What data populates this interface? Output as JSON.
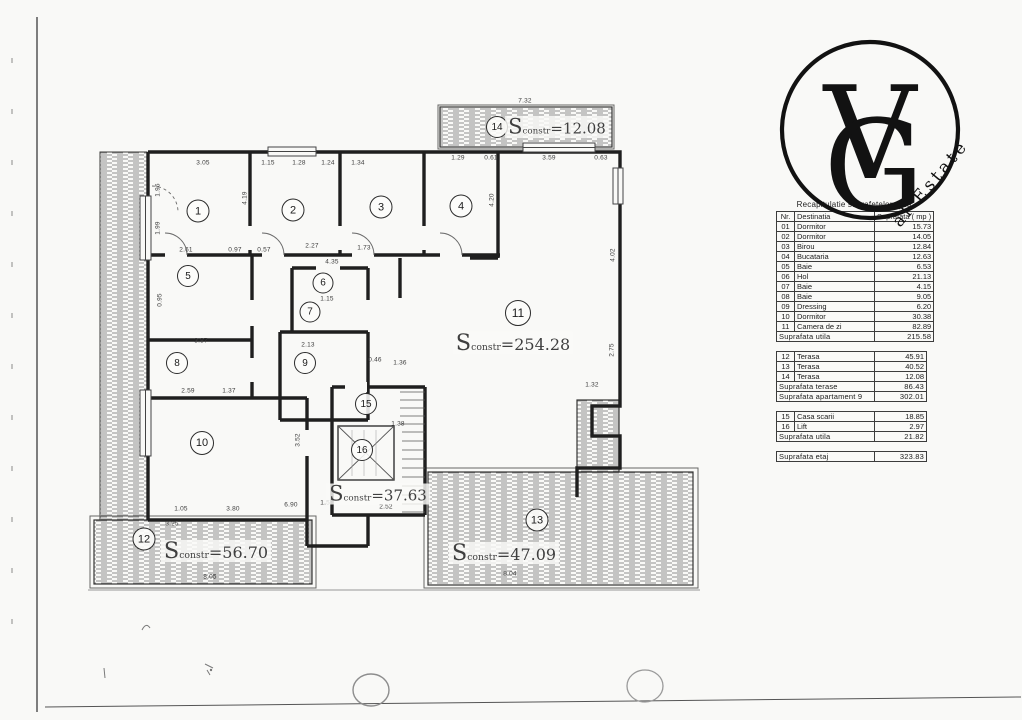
{
  "logo": {
    "monogram_v": "V",
    "monogram_g": "G",
    "tagline": "al Estate"
  },
  "summary": {
    "title": "Recapitulatie suprafetelor ap.9",
    "columns": [
      "Nr.",
      "Destinatia",
      "Suprafata ( mp )"
    ],
    "rooms": [
      {
        "nr": "01",
        "name": "Dormitor",
        "area": "15.73"
      },
      {
        "nr": "02",
        "name": "Dormitor",
        "area": "14.05"
      },
      {
        "nr": "03",
        "name": "Birou",
        "area": "12.84"
      },
      {
        "nr": "04",
        "name": "Bucataria",
        "area": "12.63"
      },
      {
        "nr": "05",
        "name": "Baie",
        "area": "6.53"
      },
      {
        "nr": "06",
        "name": "Hol",
        "area": "21.13"
      },
      {
        "nr": "07",
        "name": "Baie",
        "area": "4.15"
      },
      {
        "nr": "08",
        "name": "Baie",
        "area": "9.05"
      },
      {
        "nr": "09",
        "name": "Dressing",
        "area": "6.20"
      },
      {
        "nr": "10",
        "name": "Dormitor",
        "area": "30.38"
      },
      {
        "nr": "11",
        "name": "Camera de zi",
        "area": "82.89"
      }
    ],
    "total_utila": {
      "label": "Suprafata utila",
      "value": "215.58"
    },
    "terraces": [
      {
        "nr": "12",
        "name": "Terasa",
        "area": "45.91"
      },
      {
        "nr": "13",
        "name": "Terasa",
        "area": "40.52"
      },
      {
        "nr": "14",
        "name": "Terasa",
        "area": "12.08"
      }
    ],
    "terrace_total": {
      "label": "Suprafata terase",
      "value": "86.43"
    },
    "apartment_total": {
      "label": "Suprafata apartament 9",
      "value": "302.01"
    },
    "common": [
      {
        "nr": "15",
        "name": "Casa scarii",
        "area": "18.85"
      },
      {
        "nr": "16",
        "name": "Lift",
        "area": "2.97"
      }
    ],
    "common_total": {
      "label": "Suprafata utila",
      "value": "21.82"
    },
    "floor_total": {
      "label": "Suprafata etaj",
      "value": "323.83"
    }
  },
  "plan": {
    "room_numbers": [
      {
        "n": "1",
        "x": 198,
        "y": 211,
        "s": 21
      },
      {
        "n": "2",
        "x": 293,
        "y": 210,
        "s": 21
      },
      {
        "n": "3",
        "x": 381,
        "y": 207,
        "s": 21
      },
      {
        "n": "4",
        "x": 461,
        "y": 206,
        "s": 21
      },
      {
        "n": "5",
        "x": 188,
        "y": 276,
        "s": 20
      },
      {
        "n": "6",
        "x": 323,
        "y": 283,
        "s": 19
      },
      {
        "n": "7",
        "x": 310,
        "y": 312,
        "s": 19
      },
      {
        "n": "8",
        "x": 177,
        "y": 363,
        "s": 20
      },
      {
        "n": "9",
        "x": 305,
        "y": 363,
        "s": 20
      },
      {
        "n": "10",
        "x": 202,
        "y": 443,
        "s": 22
      },
      {
        "n": "11",
        "x": 518,
        "y": 313,
        "s": 24
      },
      {
        "n": "12",
        "x": 144,
        "y": 539,
        "s": 21
      },
      {
        "n": "13",
        "x": 537,
        "y": 520,
        "s": 21
      },
      {
        "n": "14",
        "x": 497,
        "y": 127,
        "s": 20
      },
      {
        "n": "15",
        "x": 366,
        "y": 404,
        "s": 20
      },
      {
        "n": "16",
        "x": 362,
        "y": 450,
        "s": 20
      }
    ],
    "area_labels": [
      {
        "value": "=12.08",
        "x": 557,
        "y": 127,
        "fs": 15
      },
      {
        "value": "=254.28",
        "x": 513,
        "y": 343,
        "fs": 16
      },
      {
        "value": "=37.63",
        "x": 378,
        "y": 494,
        "fs": 15
      },
      {
        "value": "=56.70",
        "x": 216,
        "y": 551,
        "fs": 16
      },
      {
        "value": "=47.09",
        "x": 504,
        "y": 553,
        "fs": 16
      }
    ],
    "area_label_prefix": {
      "big": "S",
      "sub": "constr"
    },
    "dimensions": [
      {
        "t": "3.05",
        "x": 203,
        "y": 163
      },
      {
        "t": "1.15",
        "x": 268,
        "y": 163
      },
      {
        "t": "1.28",
        "x": 299,
        "y": 163
      },
      {
        "t": "1.24",
        "x": 328,
        "y": 163
      },
      {
        "t": "1.34",
        "x": 358,
        "y": 163
      },
      {
        "t": "1.29",
        "x": 458,
        "y": 158
      },
      {
        "t": "0.61",
        "x": 491,
        "y": 158
      },
      {
        "t": "3.59",
        "x": 549,
        "y": 158
      },
      {
        "t": "0.63",
        "x": 601,
        "y": 158
      },
      {
        "t": "7.32",
        "x": 525,
        "y": 101
      },
      {
        "t": "1.96",
        "x": 158,
        "y": 190,
        "r": 90
      },
      {
        "t": "1.99",
        "x": 158,
        "y": 228,
        "r": 90
      },
      {
        "t": "4.19",
        "x": 245,
        "y": 198,
        "r": 90
      },
      {
        "t": "4.20",
        "x": 492,
        "y": 200,
        "r": 90
      },
      {
        "t": "4.02",
        "x": 613,
        "y": 255,
        "r": 90
      },
      {
        "t": "2.75",
        "x": 612,
        "y": 350,
        "r": 90
      },
      {
        "t": "2.61",
        "x": 186,
        "y": 250
      },
      {
        "t": "0.95",
        "x": 160,
        "y": 300,
        "r": 90
      },
      {
        "t": "0.97",
        "x": 235,
        "y": 250
      },
      {
        "t": "0.57",
        "x": 264,
        "y": 250
      },
      {
        "t": "2.27",
        "x": 312,
        "y": 246
      },
      {
        "t": "4.35",
        "x": 332,
        "y": 262
      },
      {
        "t": "1.73",
        "x": 364,
        "y": 248
      },
      {
        "t": "2.13",
        "x": 308,
        "y": 345
      },
      {
        "t": "3.87",
        "x": 201,
        "y": 341
      },
      {
        "t": "2.59",
        "x": 188,
        "y": 391
      },
      {
        "t": "1.37",
        "x": 229,
        "y": 391
      },
      {
        "t": "1.15",
        "x": 327,
        "y": 299
      },
      {
        "t": "0.46",
        "x": 375,
        "y": 360
      },
      {
        "t": "1.36",
        "x": 400,
        "y": 363
      },
      {
        "t": "3.52",
        "x": 298,
        "y": 440,
        "r": 90
      },
      {
        "t": "1.38",
        "x": 398,
        "y": 424
      },
      {
        "t": "1.05",
        "x": 181,
        "y": 509
      },
      {
        "t": "3.80",
        "x": 233,
        "y": 509
      },
      {
        "t": "6.90",
        "x": 291,
        "y": 505
      },
      {
        "t": "1.58",
        "x": 327,
        "y": 503
      },
      {
        "t": "2.52",
        "x": 386,
        "y": 507
      },
      {
        "t": "8.05",
        "x": 210,
        "y": 577
      },
      {
        "t": "3.25",
        "x": 172,
        "y": 524
      },
      {
        "t": "1.32",
        "x": 592,
        "y": 385
      },
      {
        "t": "8.04",
        "x": 510,
        "y": 574
      }
    ]
  }
}
